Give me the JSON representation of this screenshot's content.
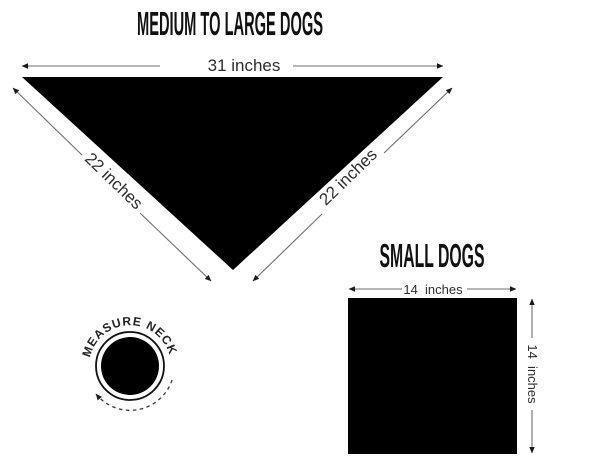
{
  "colors": {
    "background": "#ffffff",
    "shape_fill": "#000000",
    "dimension_line": "#6e6e6e",
    "arrowhead": "#1a1a1a",
    "text": "#111111"
  },
  "medium_large_section": {
    "title": "MEDIUM TO LARGE DOGS",
    "shape": "triangle",
    "top_width_label": "31 inches",
    "left_edge_label": "22 inches",
    "right_edge_label": "22 inches"
  },
  "small_section": {
    "title": "SMALL DOGS",
    "shape": "square",
    "width_label": "14  inches",
    "height_label": "14  inches"
  },
  "badge": {
    "label": "MEASURE NECK"
  }
}
